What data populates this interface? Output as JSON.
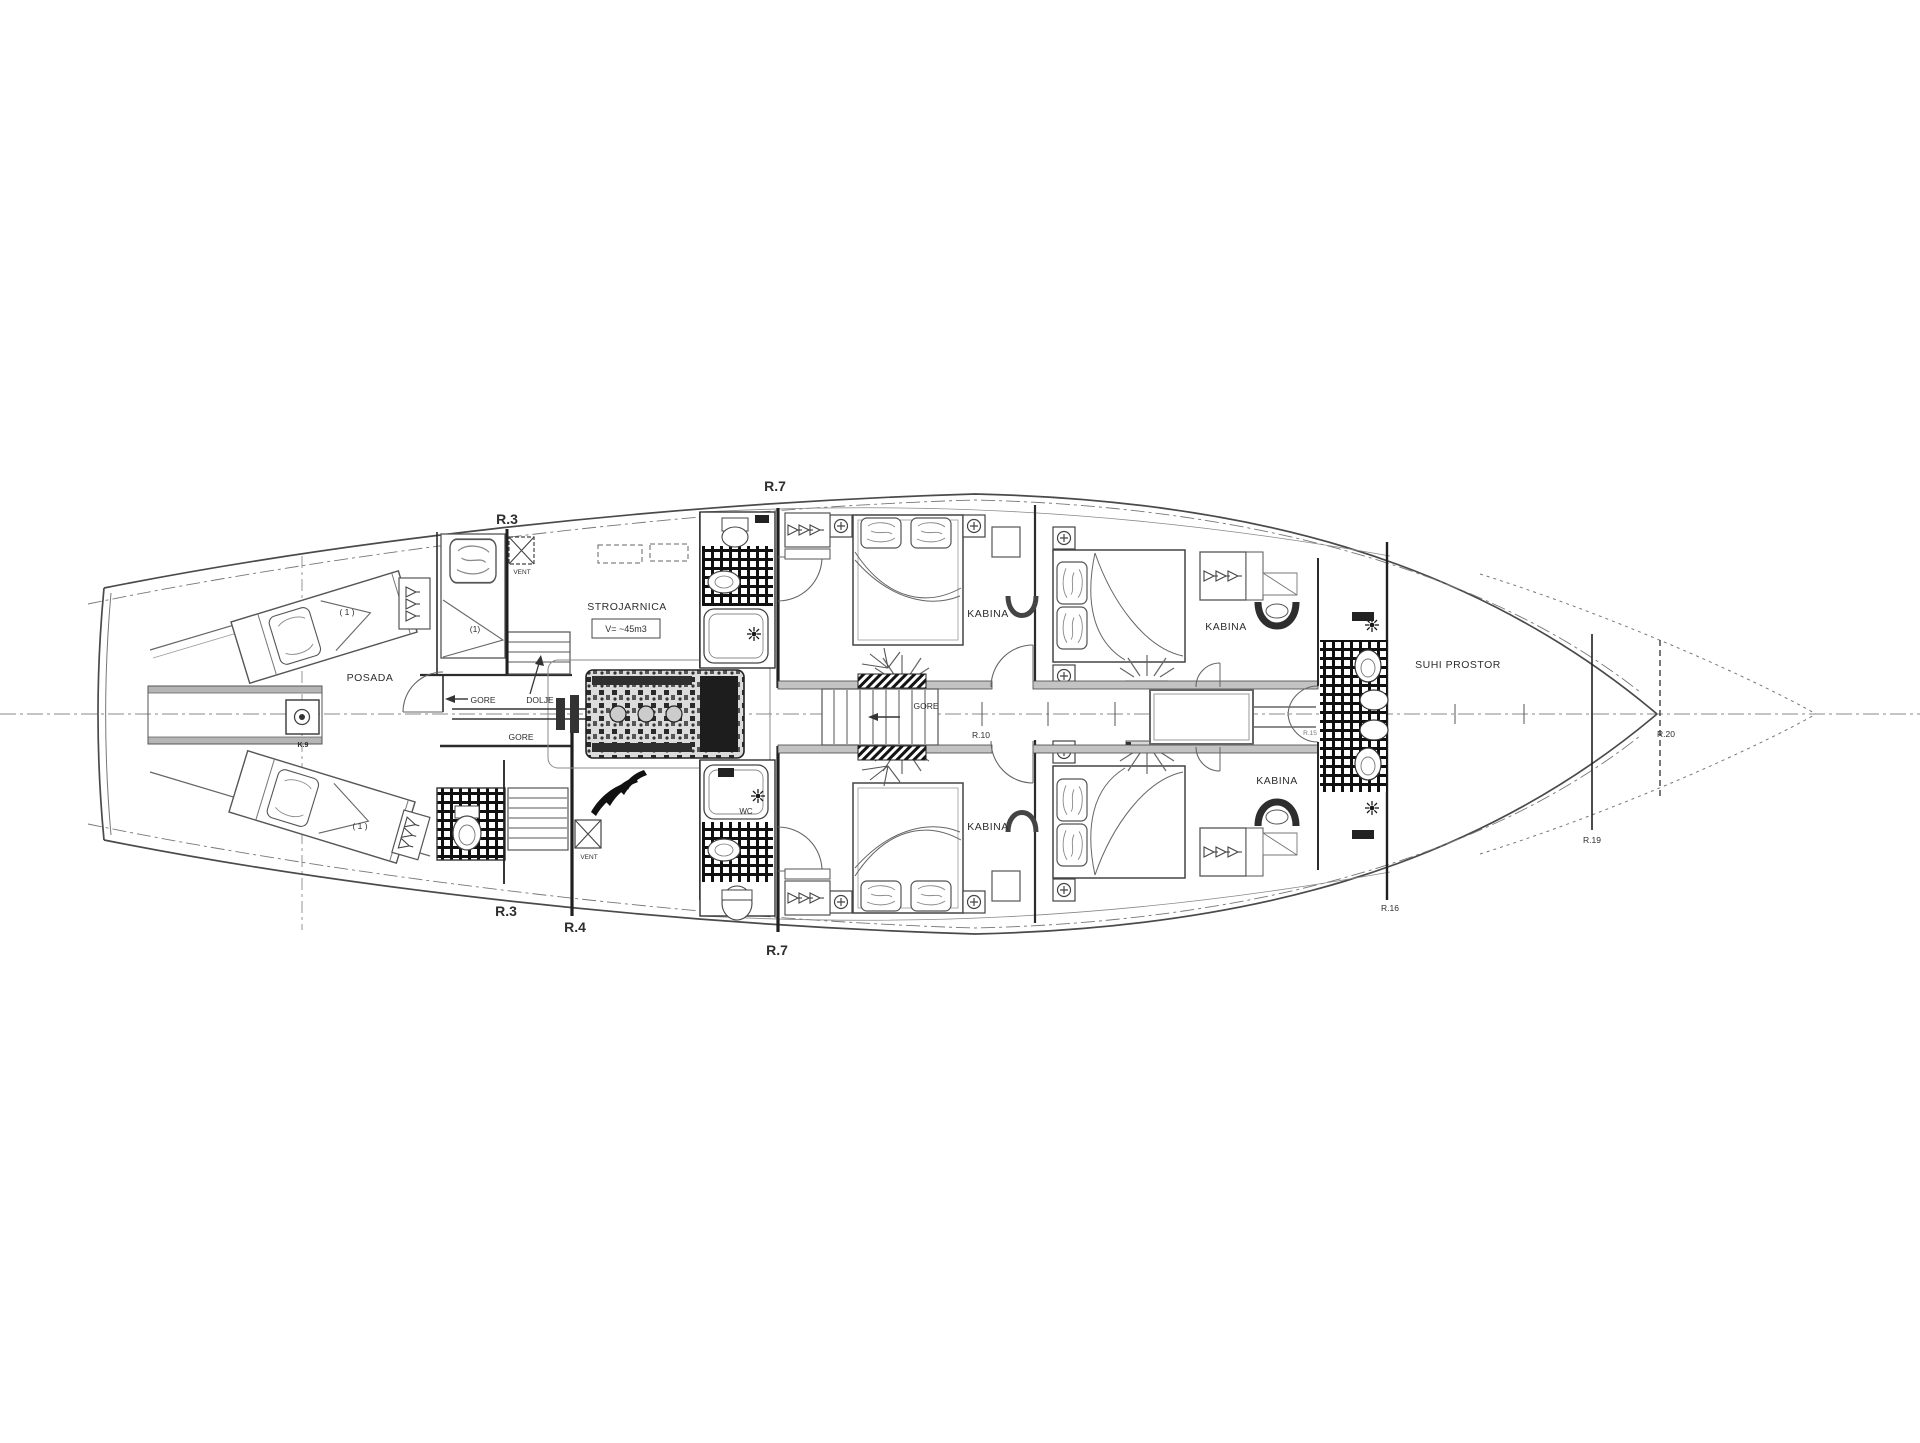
{
  "drawing": {
    "kind": "ship general arrangement deck plan"
  },
  "labels": {
    "r3_top": "R.3",
    "r7_top": "R.7",
    "r3_bottom": "R.3",
    "r4_bottom": "R.4",
    "r7_bottom": "R.7",
    "r10": "R.10",
    "r15": "R.15",
    "r16": "R.16",
    "r19": "R.19",
    "r20": "R.20"
  },
  "rooms": {
    "posada": "POSADA",
    "strojarnica": "STROJARNICA",
    "strojarnica_volume": "V= ~45m3",
    "kabina_mid_top": "KABINA",
    "kabina_mid_bottom": "KABINA",
    "kabina_right_top": "KABINA",
    "kabina_right_bottom": "KABINA",
    "suhi_prostor": "SUHI PROSTOR",
    "wc": "WC"
  },
  "annotations": {
    "gore_aft": "GORE",
    "gore_lower": "GORE",
    "gore_corridor": "GORE",
    "dolje": "DOLJE",
    "vent_top": "VENT",
    "vent_bottom": "VENT",
    "mast": "K.9",
    "berth_aft_top": "(1)",
    "berth_port_top": "( 1 )",
    "berth_port_bottom": "( 1 )"
  },
  "colors": {
    "background": "#ffffff",
    "ink": "#2e2e2e",
    "wall": "#1f1f1f",
    "hull_line": "#4a4a4a",
    "light_gray": "#b5b5b5",
    "tile": "#101010"
  }
}
